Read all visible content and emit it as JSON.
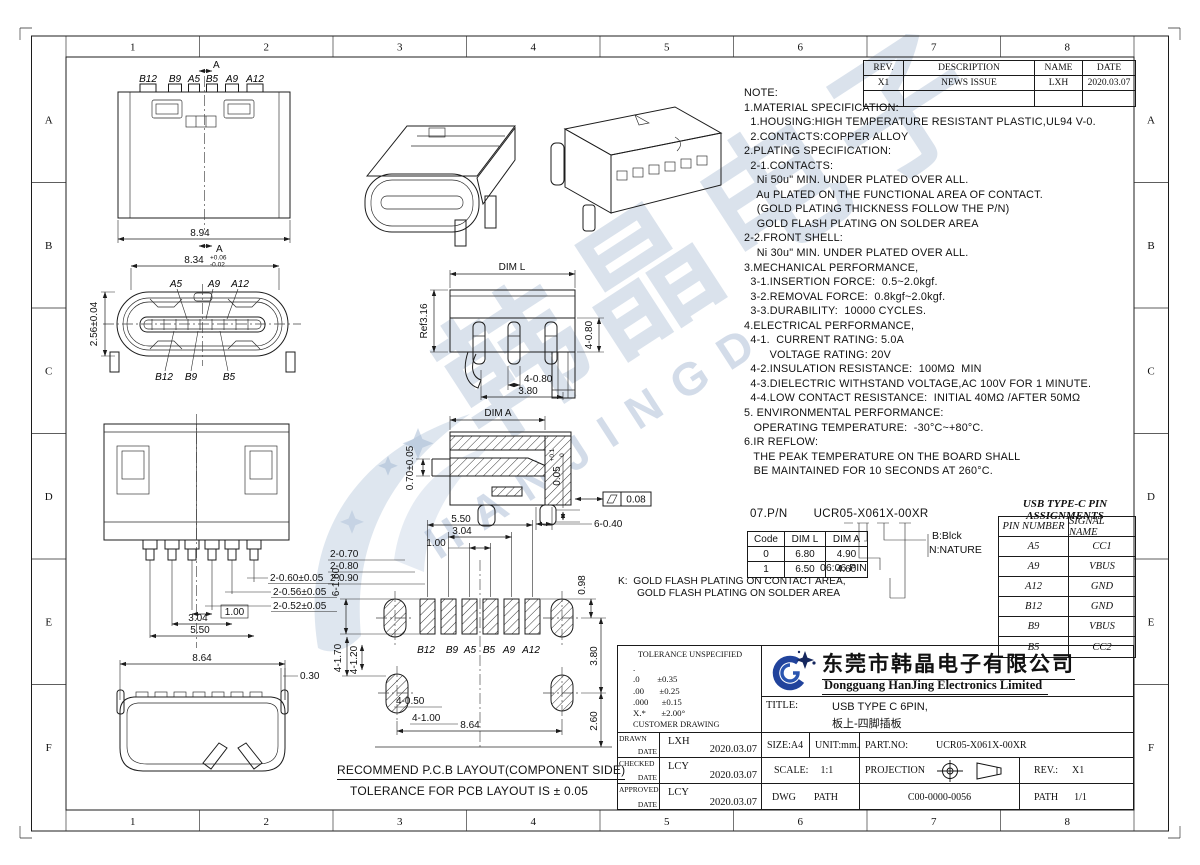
{
  "border": {
    "cols": [
      "1",
      "2",
      "3",
      "4",
      "5",
      "6",
      "7",
      "8"
    ],
    "rows": [
      "A",
      "B",
      "C",
      "D",
      "E",
      "F"
    ]
  },
  "revision_table": {
    "headers": [
      "REV.",
      "DESCRIPTION",
      "NAME",
      "DATE"
    ],
    "rows": [
      [
        "X1",
        "NEWS ISSUE",
        "LXH",
        "2020.03.07"
      ],
      [
        "",
        "",
        "",
        ""
      ]
    ]
  },
  "notes": [
    "NOTE:",
    "1.MATERIAL SPECIFICATION:",
    "  1.HOUSING:HIGH TEMPERATURE RESISTANT PLASTIC,UL94 V-0.",
    "  2.CONTACTS:COPPER ALLOY",
    "2.PLATING SPECIFICATION:",
    "  2-1.CONTACTS:",
    "    Ni 50u\" MIN. UNDER PLATED OVER ALL.",
    "    Au PLATED ON THE FUNCTIONAL AREA OF CONTACT.",
    "    (GOLD PLATING THICKNESS FOLLOW THE P/N)",
    "    GOLD FLASH PLATING ON SOLDER AREA",
    "2-2.FRONT SHELL:",
    "    Ni 30u\" MIN. UNDER PLATED OVER ALL.",
    "3.MECHANICAL PERFORMANCE,",
    "  3-1.INSERTION FORCE:  0.5~2.0kgf.",
    "  3-2.REMOVAL FORCE:  0.8kgf~2.0kgf.",
    "  3-3.DURABILITY:  10000 CYCLES.",
    "4.ELECTRICAL PERFORMANCE,",
    "  4-1.  CURRENT RATING: 5.0A",
    "        VOLTAGE RATING: 20V",
    "  4-2.INSULATION RESISTANCE:  100MΩ  MIN",
    "  4-3.DIELECTRIC WITHSTAND VOLTAGE,AC 100V FOR 1 MINUTE.",
    "  4-4.LOW CONTACT RESISTANCE:  INITIAL 40MΩ /AFTER 50MΩ",
    "5. ENVIRONMENTAL PERFORMANCE:",
    "   OPERATING TEMPERATURE:  -30°C~+80°C.",
    "6.IR REFLOW:",
    "   THE PEAK TEMPERATURE ON THE BOARD SHALL",
    "   BE MAINTAINED FOR 10 SECONDS AT 260°C."
  ],
  "pn_section": {
    "label": "07.P/N",
    "part_number": "UCR05-X061X-00XR",
    "code_table": {
      "headers": [
        "Code",
        "DIM L",
        "DIM A"
      ],
      "rows": [
        [
          "0",
          "6.80",
          "4.90"
        ],
        [
          "1",
          "6.50",
          "4.60"
        ]
      ]
    },
    "color_b": "B:Blck",
    "color_n": "N:NATURE",
    "pin_note": "06:06 PIN",
    "k_note_1": "K:  GOLD FLASH PLATING ON CONTACT AREA,",
    "k_note_2": "GOLD FLASH PLATING ON SOLDER AREA"
  },
  "pin_table": {
    "title": "USB TYPE-C PIN ASSIGNMENTS",
    "headers": [
      "PIN NUMBER",
      "SIGNAL NAME"
    ],
    "rows": [
      [
        "A5",
        "CC1"
      ],
      [
        "A9",
        "VBUS"
      ],
      [
        "A12",
        "GND"
      ],
      [
        "B12",
        "GND"
      ],
      [
        "B9",
        "VBUS"
      ],
      [
        "B5",
        "CC2"
      ]
    ]
  },
  "title_block": {
    "tolerance": {
      "heading": "TOLERANCE UNSPECIFIED",
      "lines": [
        ".",
        ".0        ±0.35",
        ".00       ±0.25",
        ".000      ±0.15",
        "X.*       ±2.00°"
      ],
      "footer": "CUSTOMER DRAWING"
    },
    "company_cn": "东莞市韩晶电子有限公司",
    "company_en": "Dongguang HanJing Electronics Limited",
    "title_label": "TITLE:",
    "title_line1": "USB TYPE C 6PIN,",
    "title_line2": "板上-四脚插板",
    "drawn_label": "DRAWN",
    "checked_label": "CHECKED",
    "approved_label": "APPROVED",
    "date_label": "DATE",
    "drawn_name": "LXH",
    "checked_name": "LCY",
    "approved_name": "LCY",
    "drawn_date": "2020.03.07",
    "checked_date": "2020.03.07",
    "approved_date": "2020.03.07",
    "size": "SIZE:A4",
    "unit": "UNIT:mm.",
    "part_no_label": "PART.NO:",
    "part_no": "UCR05-X061X-00XR",
    "scale_label": "SCALE:",
    "scale": "1:1",
    "projection": "PROJECTION",
    "rev_label": "REV.:",
    "rev": "X1",
    "dwg": "DWG",
    "path": "PATH",
    "dwg_no": "C00-0000-0056",
    "path2": "PATH",
    "sheet": "1/1"
  },
  "watermark": {
    "cn": "韩晶电子",
    "en": "HANJINGD"
  },
  "drawings": {
    "recommend1": "RECOMMEND P.C.B LAYOUT(COMPONENT SIDE)",
    "recommend2": "TOLERANCE FOR PCB LAYOUT IS ± 0.05",
    "top_view": {
      "pins": [
        "B12",
        "B9",
        "A5",
        "B5",
        "A9",
        "A12"
      ],
      "section": "A",
      "w": "8.94",
      "iw": "8.34",
      "iw_tp": "+0.06",
      "iw_tm": "-0.02"
    },
    "front_view": {
      "top": [
        "A5",
        "A9",
        "A12"
      ],
      "bottom": [
        "B12",
        "B9",
        "B5"
      ],
      "h": "2.56±0.04"
    },
    "side_view": {
      "dim": "DIM L",
      "ref": "Ref3.16",
      "v": "4-0.80",
      "d": "4-0.80",
      "span": "3.80"
    },
    "section_view": {
      "dim": "DIM A",
      "t": "0.70±0.05",
      "s": "0.05",
      "st": "+0.1",
      "sb": "0",
      "flat": "0.08",
      "pad": "6-0.40"
    },
    "bottom_view": {
      "d1": "2-0.60±0.05",
      "d2": "2-0.56±0.05",
      "d3": "2-0.52±0.05",
      "p1": "1.00",
      "p2": "3.04",
      "p3": "5.50"
    },
    "profile_view": {
      "w": "8.64",
      "lead": "0.30"
    },
    "pcb": {
      "pins": [
        "B12",
        "B9",
        "A5",
        "B5",
        "A9",
        "A12"
      ],
      "d550": "5.50",
      "d304": "3.04",
      "d100": "1.00",
      "d070": "2-0.70",
      "d080": "2-0.80",
      "d090": "2-0.90",
      "d160": "6-1.60",
      "d098": "0.98",
      "d380": "3.80",
      "d260": "2.60",
      "d170": "4-1.70",
      "d120": "4-1.20",
      "d050": "4-0.50",
      "d110": "4-1.00",
      "d864": "8.64"
    }
  }
}
